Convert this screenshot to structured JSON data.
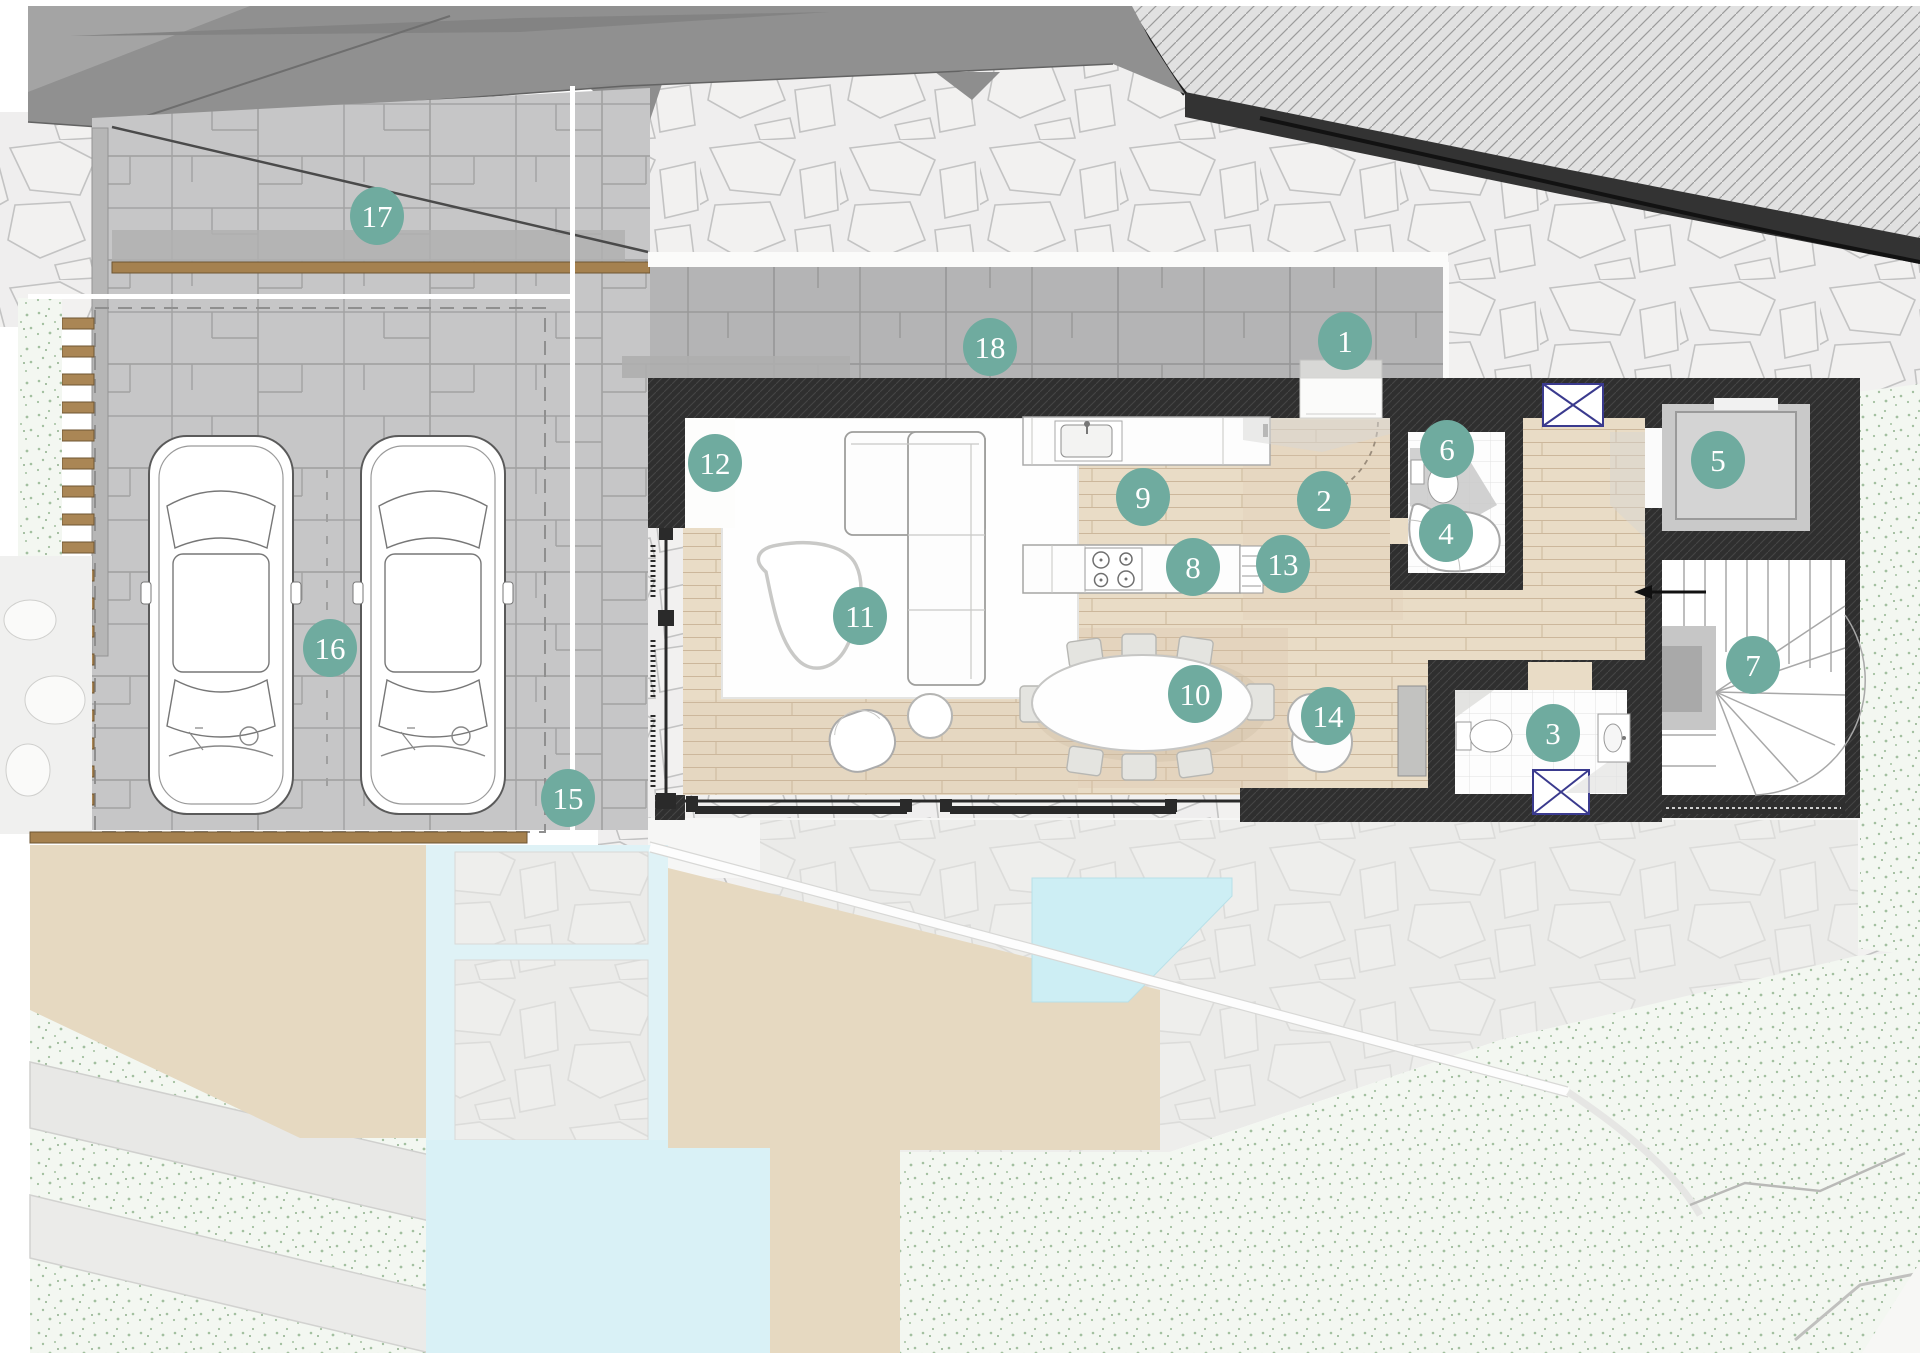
{
  "plan": {
    "type": "architectural-floor-plan",
    "markers": [
      {
        "n": "1",
        "x": 1345,
        "y": 341
      },
      {
        "n": "2",
        "x": 1324,
        "y": 500
      },
      {
        "n": "3",
        "x": 1553,
        "y": 733
      },
      {
        "n": "4",
        "x": 1446,
        "y": 533
      },
      {
        "n": "5",
        "x": 1718,
        "y": 460
      },
      {
        "n": "6",
        "x": 1447,
        "y": 449
      },
      {
        "n": "7",
        "x": 1753,
        "y": 665
      },
      {
        "n": "8",
        "x": 1193,
        "y": 567
      },
      {
        "n": "9",
        "x": 1143,
        "y": 497
      },
      {
        "n": "10",
        "x": 1195,
        "y": 694
      },
      {
        "n": "11",
        "x": 860,
        "y": 616
      },
      {
        "n": "12",
        "x": 715,
        "y": 463
      },
      {
        "n": "13",
        "x": 1283,
        "y": 564
      },
      {
        "n": "14",
        "x": 1328,
        "y": 716
      },
      {
        "n": "15",
        "x": 568,
        "y": 798
      },
      {
        "n": "16",
        "x": 330,
        "y": 648
      },
      {
        "n": "17",
        "x": 377,
        "y": 216
      },
      {
        "n": "18",
        "x": 990,
        "y": 347
      }
    ],
    "style": {
      "marker_fill": "#6fab9f",
      "marker_text": "#ffffff",
      "marker_rx": 27,
      "marker_ry": 29,
      "wall_color": "#2f2f2f",
      "wood_floor": "#e9dcc6",
      "pool_water": "#d9f1f6",
      "grass_dotted": "#f3f7f1",
      "driveway_paving": "#c6c6c7",
      "road": "#909090",
      "terrace_tan": "#e6d9c1",
      "window_symbol_blue": "#3a3a8e",
      "wood_deck_brown": "#a5814f"
    }
  }
}
